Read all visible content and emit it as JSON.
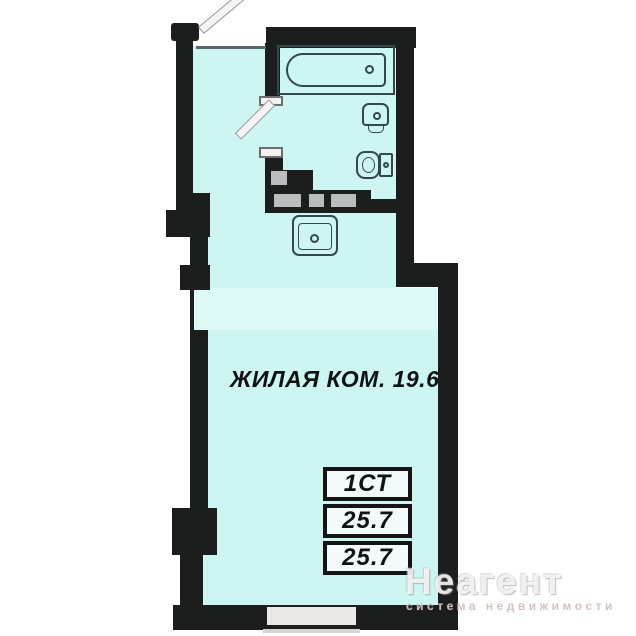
{
  "plan": {
    "room_label": "ЖИЛАЯ КОМ. 19.6",
    "info_table": {
      "rows": [
        "1СТ",
        "25.7",
        "25.7"
      ]
    },
    "watermark": {
      "brand": "Неагент",
      "tagline": "система недвижимости"
    },
    "fixtures": [
      {
        "name": "bathtub"
      },
      {
        "name": "washbasin"
      },
      {
        "name": "toilet"
      },
      {
        "name": "kitchen-sink"
      },
      {
        "name": "entrance-door"
      },
      {
        "name": "bathroom-door"
      },
      {
        "name": "window"
      }
    ],
    "colors": {
      "room_fill": "#cdf5f2",
      "zone_band_fill": "#dcf9f6",
      "wall": "#1c1d1d",
      "vent_shaft": "#b9bdbd",
      "window_fill": "#ebe9e5",
      "fixture_outline": "#32484a",
      "table_border": "#151515",
      "label_text": "#101314",
      "watermark_text": "#e8e4e0"
    }
  }
}
